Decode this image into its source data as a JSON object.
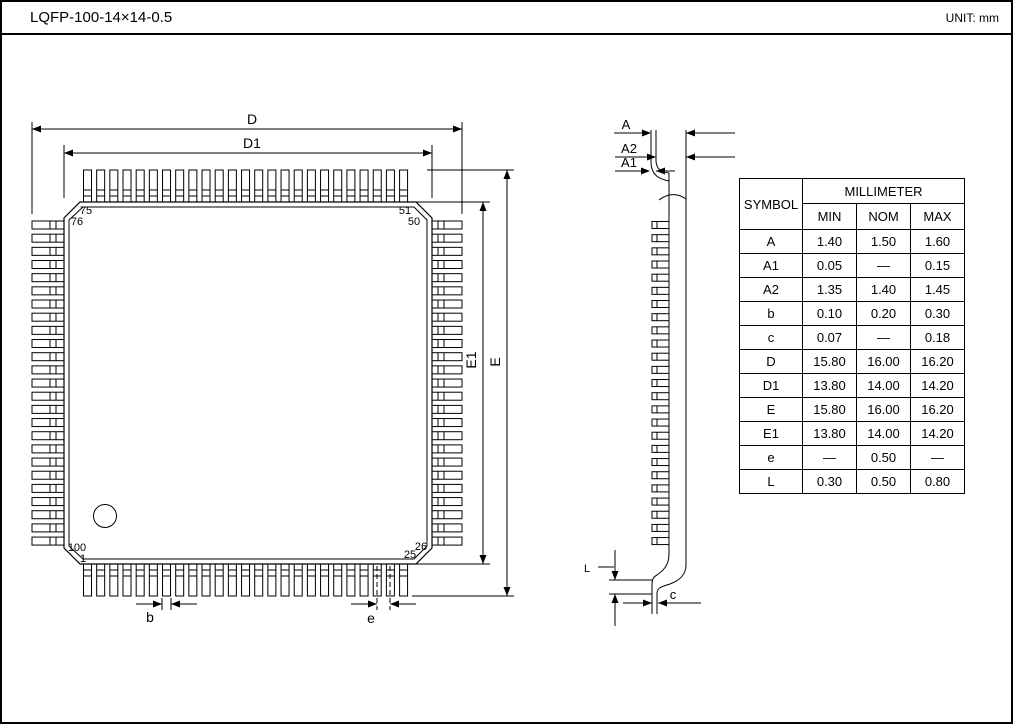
{
  "title_bar": {
    "title": "LQFP-100-14×14-0.5",
    "unit": "UNIT: mm"
  },
  "drawing": {
    "dimension_labels": {
      "D": "D",
      "D1": "D1",
      "E": "E",
      "E1": "E1",
      "b": "b",
      "e": "e",
      "A": "A",
      "A2": "A2",
      "A1": "A1",
      "L": "L",
      "c": "c"
    },
    "pin_labels": {
      "p75": "75",
      "p76": "76",
      "p51": "51",
      "p50": "50",
      "p100": "100",
      "p1": "1",
      "p26": "26",
      "p25": "25"
    }
  },
  "table": {
    "header": {
      "symbol": "SYMBOL",
      "millimeter": "MILLIMETER",
      "min": "MIN",
      "nom": "NOM",
      "max": "MAX"
    },
    "rows": [
      {
        "symbol": "A",
        "min": "1.40",
        "nom": "1.50",
        "max": "1.60"
      },
      {
        "symbol": "A1",
        "min": "0.05",
        "nom": "—",
        "max": "0.15"
      },
      {
        "symbol": "A2",
        "min": "1.35",
        "nom": "1.40",
        "max": "1.45"
      },
      {
        "symbol": "b",
        "min": "0.10",
        "nom": "0.20",
        "max": "0.30"
      },
      {
        "symbol": "c",
        "min": "0.07",
        "nom": "—",
        "max": "0.18"
      },
      {
        "symbol": "D",
        "min": "15.80",
        "nom": "16.00",
        "max": "16.20"
      },
      {
        "symbol": "D1",
        "min": "13.80",
        "nom": "14.00",
        "max": "14.20"
      },
      {
        "symbol": "E",
        "min": "15.80",
        "nom": "16.00",
        "max": "16.20"
      },
      {
        "symbol": "E1",
        "min": "13.80",
        "nom": "14.00",
        "max": "14.20"
      },
      {
        "symbol": "e",
        "min": "—",
        "nom": "0.50",
        "max": "—"
      },
      {
        "symbol": "L",
        "min": "0.30",
        "nom": "0.50",
        "max": "0.80"
      }
    ]
  }
}
